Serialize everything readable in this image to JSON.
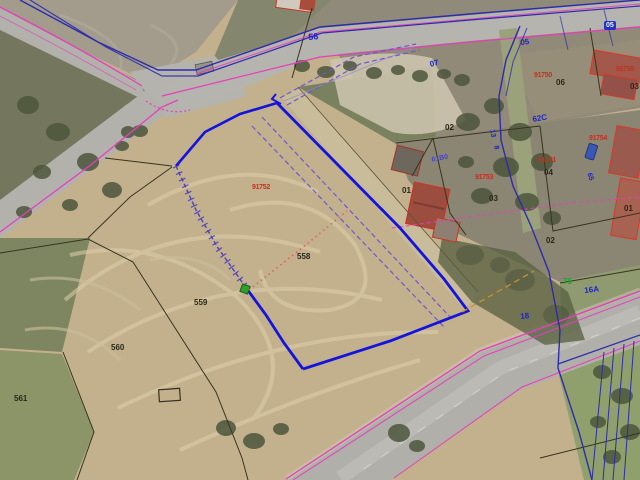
{
  "map": {
    "labels": [
      {
        "name": "road-label-56",
        "text": "56",
        "x": 308,
        "y": 33,
        "style": "blue",
        "rot": -4,
        "size": 9
      },
      {
        "name": "road-label-05",
        "text": "05",
        "x": 520,
        "y": 39,
        "style": "blue",
        "rot": -6,
        "size": 8
      },
      {
        "name": "road-label-07",
        "text": "07",
        "x": 429,
        "y": 61,
        "style": "blue",
        "rot": -14,
        "size": 8
      },
      {
        "name": "parcel-label-06",
        "text": "06",
        "x": 556,
        "y": 79,
        "style": "black",
        "rot": 0,
        "size": 8
      },
      {
        "name": "sector-code-91750",
        "text": "91750",
        "x": 534,
        "y": 72,
        "style": "red",
        "rot": 0,
        "size": 7
      },
      {
        "name": "parcel-label-02-upper",
        "text": "02",
        "x": 445,
        "y": 124,
        "style": "black",
        "rot": 0,
        "size": 8
      },
      {
        "name": "road-label-62C",
        "text": "62C",
        "x": 532,
        "y": 116,
        "style": "blue",
        "rot": -10,
        "size": 8
      },
      {
        "name": "road-label-13",
        "text": "13",
        "x": 495,
        "y": 129,
        "style": "blue",
        "rot": 78,
        "size": 7
      },
      {
        "name": "road-label-8",
        "text": "8",
        "x": 499,
        "y": 145,
        "style": "blue",
        "rot": 78,
        "size": 7
      },
      {
        "name": "sector-code-61B0",
        "text": "61B0",
        "x": 431,
        "y": 157,
        "style": "blue-sm",
        "rot": -12,
        "size": 7
      },
      {
        "name": "sector-code-91751",
        "text": "91751",
        "x": 538,
        "y": 157,
        "style": "red",
        "rot": 0,
        "size": 7
      },
      {
        "name": "parcel-label-04",
        "text": "04",
        "x": 544,
        "y": 169,
        "style": "black",
        "rot": 0,
        "size": 8
      },
      {
        "name": "sector-code-91753",
        "text": "91753",
        "x": 475,
        "y": 174,
        "style": "red",
        "rot": 0,
        "size": 7
      },
      {
        "name": "parcel-label-01-house",
        "text": "01",
        "x": 402,
        "y": 187,
        "style": "black",
        "rot": 0,
        "size": 8
      },
      {
        "name": "parcel-label-03",
        "text": "03",
        "x": 489,
        "y": 195,
        "style": "black",
        "rot": 0,
        "size": 8
      },
      {
        "name": "parcel-label-02-lower",
        "text": "02",
        "x": 546,
        "y": 237,
        "style": "black",
        "rot": 0,
        "size": 8
      },
      {
        "name": "parcel-label-01-right",
        "text": "01",
        "x": 624,
        "y": 205,
        "style": "black",
        "rot": 0,
        "size": 8
      },
      {
        "name": "road-label-65",
        "text": "65",
        "x": 592,
        "y": 172,
        "style": "blue",
        "rot": 70,
        "size": 7
      },
      {
        "name": "road-label-05-box",
        "text": "05",
        "x": 604,
        "y": 21,
        "style": "bluebox",
        "rot": 0,
        "size": 7
      },
      {
        "name": "sector-code-91754",
        "text": "91754",
        "x": 589,
        "y": 135,
        "style": "red",
        "rot": 0,
        "size": 7
      },
      {
        "name": "sector-code-91752",
        "text": "91752",
        "x": 252,
        "y": 184,
        "style": "red",
        "rot": 0,
        "size": 7
      },
      {
        "name": "parcel-label-558",
        "text": "558",
        "x": 297,
        "y": 253,
        "style": "black",
        "rot": 0,
        "size": 8
      },
      {
        "name": "parcel-label-559",
        "text": "559",
        "x": 194,
        "y": 299,
        "style": "black",
        "rot": 0,
        "size": 8
      },
      {
        "name": "parcel-label-560",
        "text": "560",
        "x": 111,
        "y": 344,
        "style": "black",
        "rot": 0,
        "size": 8
      },
      {
        "name": "parcel-label-561",
        "text": "561",
        "x": 14,
        "y": 395,
        "style": "black",
        "rot": 0,
        "size": 8
      },
      {
        "name": "road-label-76",
        "text": "76",
        "x": 563,
        "y": 278,
        "style": "green",
        "rot": 0,
        "size": 8
      },
      {
        "name": "road-label-16A",
        "text": "16A",
        "x": 584,
        "y": 287,
        "style": "blue",
        "rot": -6,
        "size": 8
      },
      {
        "name": "road-label-18",
        "text": "18",
        "x": 520,
        "y": 313,
        "style": "blue",
        "rot": -6,
        "size": 8
      },
      {
        "name": "parcel-label-03-edge",
        "text": "03",
        "x": 630,
        "y": 83,
        "style": "black",
        "rot": 0,
        "size": 8
      },
      {
        "name": "sector-code-91755",
        "text": "91755",
        "x": 616,
        "y": 66,
        "style": "red",
        "rot": 0,
        "size": 7
      }
    ],
    "colors": {
      "selected_parcel_blue": "#1414dc",
      "cadastral_magenta": "#e63fbc",
      "route_navy": "#2c2cab",
      "guide_purple_dashed": "#6e57cf",
      "split_red_dotted": "#e06060",
      "vertex_marker_green": "#2f9e2f",
      "building_outline_red": "#d43a2a",
      "orange_guide_dashed": "#c8922f",
      "field_tan": "#c3b18e",
      "road_gray": "#b6b4ae"
    }
  }
}
